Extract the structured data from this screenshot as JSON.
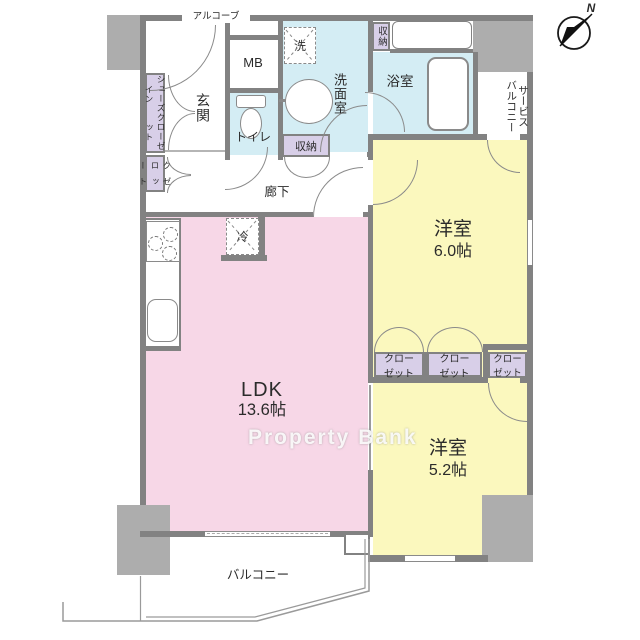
{
  "floorplan": {
    "watermark": "Property Bank",
    "compass_north": "N",
    "rooms": {
      "alcove": "アルコーブ",
      "entrance": "玄関",
      "corridor": "廊下",
      "toilet": "トイレ",
      "washroom": "洗面室",
      "bathroom": "浴室",
      "ldk_label": "LDK",
      "ldk_area": "13.6帖",
      "western6_label": "洋室",
      "western6_area": "6.0帖",
      "western5_label": "洋室",
      "western5_area": "5.2帖",
      "balcony": "バルコニー",
      "service_balcony_line1": "サービス",
      "service_balcony_line2": "バルコニー"
    },
    "fixtures": {
      "meter_box": "MB",
      "washer": "洗",
      "refrigerator": "冷"
    },
    "storage": {
      "shoes_closet_line1": "シューズイン",
      "shoes_closet_line2": "クローゼット",
      "hall_closet_line1": "クロー",
      "hall_closet_line2": "ゼット",
      "upper_storage": "収納",
      "corridor_storage": "収納",
      "closet1_line1": "クロー",
      "closet1_line2": "ゼット",
      "closet2_line1": "クロー",
      "closet2_line2": "ゼット",
      "closet3_line1": "クロー",
      "closet3_line2": "ゼット"
    },
    "colors": {
      "ldk_pink": "#F7D7E7",
      "room_yellow": "#FBF8BE",
      "wet_blue": "#D4EDF4",
      "closet_purple": "#D8CFE8",
      "wall_gray": "#828282",
      "block_gray": "#ADADAD"
    }
  }
}
